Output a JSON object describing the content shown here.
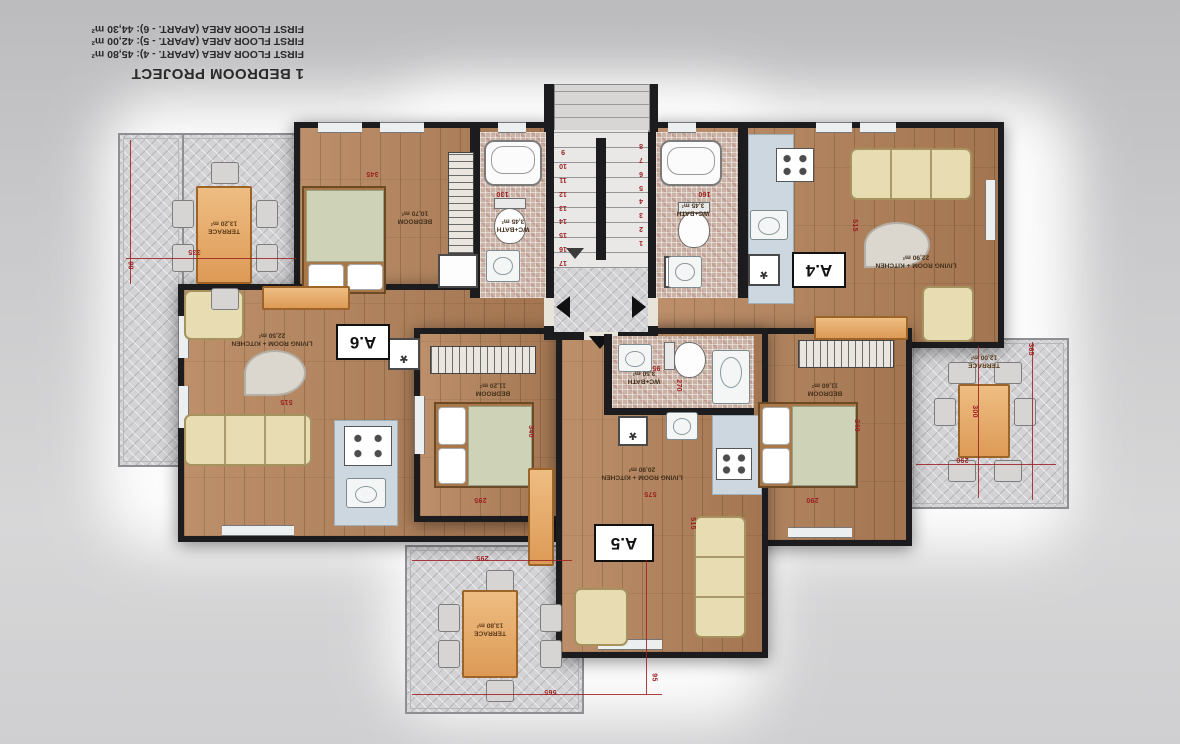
{
  "title_block": {
    "project": "1 BEDROOM PROJECT",
    "areas": [
      "FIRST FLOOR AREA (APART. - 4): 45,80 m²",
      "FIRST FLOOR AREA (APART. - 5): 42,00 m²",
      "FIRST FLOOR AREA (APART. - 6): 44,30 m²"
    ]
  },
  "apartments": {
    "a4": {
      "label": "A.4",
      "living": "LIVING ROOM + KITCHEN",
      "living_area": "22,90 m²",
      "bedroom": "BEDROOM",
      "bedroom_area": "11,60 m²",
      "bath": "WC+BATH",
      "bath_area": "3,45 m²",
      "terrace": "TERRACE",
      "terrace_area": "12,00 m²"
    },
    "a5": {
      "label": "A.5",
      "living": "LIVING ROOM + KITCHEN",
      "living_area": "20,90 m²",
      "bedroom": "BEDROOM",
      "bedroom_area": "11,20 m²",
      "bath": "WC+BATH",
      "bath_area": "3,50 m²",
      "terrace": "TERRACE",
      "terrace_area": "13,80 m²"
    },
    "a6": {
      "label": "A.6",
      "living": "LIVING ROOM + KITCHEN",
      "living_area": "22,50 m²",
      "bedroom": "BEDROOM",
      "bedroom_area": "10,70 m²",
      "bath": "WC+BATH",
      "bath_area": "3,45 m²",
      "terrace": "TERRACE",
      "terrace_area": "13,20 m²"
    }
  },
  "dimensions": {
    "t6_w": "335",
    "t6_h": "90",
    "a6_bed": "345",
    "a6_bath": "130",
    "a6_living": "515",
    "a4_bath": "160",
    "a4_living": "515",
    "a4_bed_w": "290",
    "a4_bed_h": "340",
    "a5_living_w": "575",
    "a5_living_h": "515",
    "a5_bath_h": "270",
    "a5_bath_w": "95",
    "a5_bed_w": "295",
    "a5_bed_h": "340",
    "t5_w": "295",
    "t5_bottom": "565",
    "t5_h": "95",
    "t4_table": "300",
    "t4_w": "290",
    "t4_h": "365"
  },
  "stairs": {
    "left": [
      "9",
      "10",
      "11",
      "12",
      "13",
      "14",
      "15",
      "16",
      "17"
    ],
    "right": [
      "8",
      "7",
      "6",
      "5",
      "4",
      "3",
      "2",
      "1"
    ]
  },
  "icons": {
    "washer_glyph": "*"
  },
  "colors": {
    "dim_red": "#9c2020",
    "wall": "#1c1c1e",
    "wood": "#b5835a",
    "terrace_tile": "#d3d2d4",
    "accent_orange": "#dd9a56"
  }
}
